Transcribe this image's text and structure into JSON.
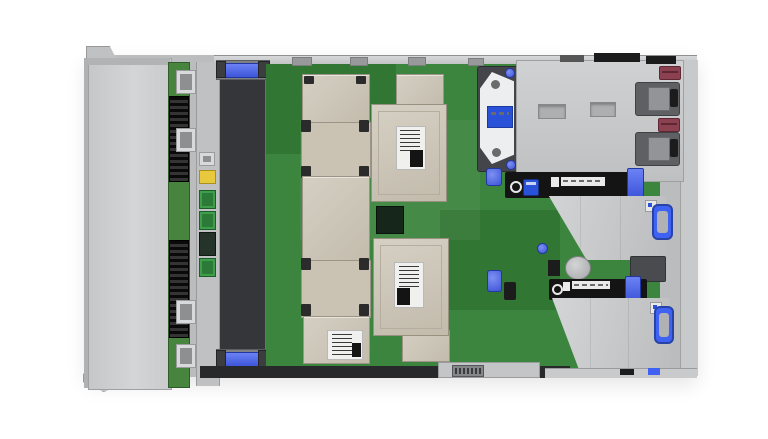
{
  "meta": {
    "title": "Rack server internal top view",
    "description": "Top-down photograph of a 2U rack server with its access panel removed, showing front drive cage, drive backplane, six hot-plug fan modules with magenta handles and blue release latches, two processor heatsinks on a green system board, CMOS coin battery, energy-pack bracket, two PCIe riser cages with blue touchpoint handles and labeled black bezels, and two power-supply handles with maroon pull tabs at the rear."
  },
  "palette": {
    "background": "#ffffff",
    "chassis_light": "#d4d5d7",
    "chassis_mid": "#bbbcbe",
    "chassis_dark": "#8f9092",
    "fan_body": "#46474a",
    "fan_handle_magenta": "#9c3752",
    "touchpoint_blue": "#3f62f2",
    "board_green": "#3c853e",
    "backplane_green": "#47853e",
    "heatsink_tan": "#ccc6ba",
    "copper_spring": "#c08448",
    "psu_tab_maroon": "#8c4150",
    "label_black": "#141414",
    "label_white": "#f0f0ee",
    "connector_green": "#3f9e4c",
    "battery_silver": "#b5b6b8"
  },
  "components": {
    "fan_bank": {
      "name": "hot-plug-fan-modules",
      "count": 6
    },
    "cpu_sockets": {
      "count": 2,
      "spring_screws_per_socket": 8
    },
    "heatsinks": {
      "count": 2
    },
    "riser_cages": {
      "count": 2
    },
    "power_supplies": {
      "handle_count": 2
    },
    "battery": {
      "name": "cmos-coin-battery",
      "count": 1
    },
    "energy_pack": {
      "name": "energy-pack-bracket",
      "count": 1
    },
    "drive_cage": {
      "name": "front-drive-cage-cover"
    }
  },
  "render": {
    "fans": {
      "count": 6,
      "x": 221,
      "y0": 78,
      "w": 44,
      "h": 45.5
    },
    "sockets": [
      {
        "x": 301,
        "y": 122
      },
      {
        "x": 301,
        "y": 260
      }
    ],
    "copper_dots": [
      [
        17,
        9
      ],
      [
        45,
        9
      ],
      [
        31,
        19
      ],
      [
        11,
        27
      ],
      [
        31,
        37
      ],
      [
        51,
        27
      ],
      [
        17,
        43
      ],
      [
        45,
        41
      ]
    ],
    "heatsinks": [
      {
        "x": 371,
        "y": 104
      },
      {
        "x": 373,
        "y": 238
      }
    ],
    "heatsink_screws": [
      [
        5,
        5
      ],
      [
        61,
        5
      ],
      [
        5,
        83
      ],
      [
        61,
        83
      ]
    ],
    "dimm_strips": [
      [
        320,
        102,
        42,
        10
      ],
      [
        320,
        176,
        42,
        10
      ],
      [
        320,
        246,
        42,
        10
      ],
      [
        336,
        320,
        26,
        10
      ]
    ],
    "chips": [
      [
        286,
        70,
        12,
        6,
        "a"
      ],
      [
        304,
        66,
        10,
        5,
        "b"
      ],
      [
        334,
        64,
        20,
        6,
        "d"
      ],
      [
        377,
        80,
        18,
        10,
        "b"
      ],
      [
        415,
        82,
        15,
        7,
        "b"
      ],
      [
        444,
        84,
        22,
        8,
        "b"
      ],
      [
        450,
        104,
        17,
        8,
        "b"
      ],
      [
        468,
        66,
        10,
        5,
        "a"
      ],
      [
        452,
        64,
        26,
        5,
        "d"
      ],
      [
        498,
        64,
        10,
        6,
        "b"
      ],
      [
        277,
        132,
        15,
        40,
        "b"
      ],
      [
        279,
        206,
        13,
        20,
        "b"
      ],
      [
        280,
        299,
        13,
        38,
        "b"
      ],
      [
        271,
        178,
        6,
        20,
        "d"
      ],
      [
        271,
        250,
        6,
        26,
        "d"
      ],
      [
        410,
        214,
        8,
        8,
        "a"
      ],
      [
        300,
        240,
        8,
        10,
        "a"
      ],
      [
        330,
        236,
        6,
        8,
        "b"
      ],
      [
        470,
        120,
        8,
        14,
        "b"
      ],
      [
        474,
        142,
        12,
        8,
        "a"
      ],
      [
        470,
        168,
        10,
        8,
        "b"
      ],
      [
        478,
        196,
        14,
        9,
        "b"
      ],
      [
        470,
        224,
        9,
        8,
        "a"
      ],
      [
        462,
        240,
        18,
        10,
        "b"
      ],
      [
        487,
        250,
        8,
        8,
        "c"
      ],
      [
        459,
        150,
        6,
        6,
        "c"
      ],
      [
        445,
        148,
        8,
        16,
        "b"
      ],
      [
        466,
        146,
        8,
        16,
        "b"
      ],
      [
        292,
        344,
        10,
        7,
        "b"
      ],
      [
        320,
        344,
        17,
        8,
        "b"
      ],
      [
        350,
        342,
        12,
        6,
        "a"
      ],
      [
        380,
        344,
        16,
        8,
        "b"
      ],
      [
        410,
        344,
        10,
        6,
        "a"
      ],
      [
        432,
        340,
        13,
        8,
        "b"
      ],
      [
        452,
        352,
        12,
        6,
        "b"
      ],
      [
        475,
        322,
        22,
        12,
        "b"
      ],
      [
        500,
        324,
        13,
        8,
        "a"
      ],
      [
        520,
        318,
        9,
        6,
        "b"
      ],
      [
        476,
        340,
        28,
        8,
        "a"
      ],
      [
        512,
        342,
        15,
        6,
        "b"
      ],
      [
        534,
        336,
        8,
        8,
        "a"
      ],
      [
        548,
        340,
        12,
        6,
        "b"
      ],
      [
        522,
        354,
        24,
        7,
        "a"
      ],
      [
        554,
        354,
        9,
        5,
        "b"
      ],
      [
        470,
        356,
        16,
        6,
        "b"
      ],
      [
        507,
        200,
        10,
        8,
        "c"
      ],
      [
        520,
        216,
        8,
        6,
        "a"
      ],
      [
        500,
        230,
        8,
        8,
        "a"
      ]
    ],
    "chip_colors": {
      "a": "#1b3a22",
      "b": "#121212",
      "c": "#c6c6c6",
      "d": "#2f6a33"
    },
    "rivets": [
      [
        98,
        155
      ],
      [
        124,
        155
      ],
      [
        150,
        155
      ],
      [
        98,
        168
      ],
      [
        124,
        168
      ],
      [
        150,
        168
      ],
      [
        98,
        253
      ],
      [
        124,
        253
      ],
      [
        150,
        253
      ],
      [
        98,
        266
      ],
      [
        124,
        266
      ],
      [
        150,
        266
      ]
    ],
    "rivet_dashes": [
      [
        111,
        160
      ],
      [
        137,
        160
      ],
      [
        111,
        258
      ],
      [
        137,
        258
      ]
    ],
    "cage_screws_dark": [
      [
        95,
        90
      ],
      [
        95,
        186
      ],
      [
        95,
        282
      ],
      [
        100,
        364
      ],
      [
        92,
        62
      ]
    ],
    "psu_dots": [
      [
        549,
        85
      ],
      [
        606,
        83
      ],
      [
        551,
        147
      ],
      [
        608,
        145
      ],
      [
        536,
        69
      ],
      [
        665,
        72
      ]
    ],
    "cage1_dots": [
      [
        590,
        213
      ],
      [
        606,
        227
      ],
      [
        648,
        205
      ],
      [
        650,
        245
      ],
      [
        572,
        203
      ]
    ],
    "cage2_dots": [
      [
        600,
        319
      ],
      [
        616,
        335
      ],
      [
        650,
        311
      ],
      [
        652,
        351
      ],
      [
        590,
        355
      ]
    ],
    "riser1_icons": {
      "x": 557,
      "y": 187,
      "n": 6,
      "w": 9,
      "h": 8,
      "step": 11
    },
    "riser2_icons": {
      "x": 557,
      "y": 290,
      "n": 6,
      "w": 8,
      "h": 7,
      "step": 10
    },
    "bottom_segments": [
      [
        212,
        368,
        24,
        4
      ],
      [
        252,
        369,
        18,
        4
      ],
      [
        300,
        368,
        28,
        4
      ],
      [
        354,
        369,
        20,
        4
      ],
      [
        398,
        368,
        16,
        4
      ],
      [
        470,
        369,
        14,
        4
      ],
      [
        520,
        368,
        16,
        4
      ]
    ],
    "fan_rail_dots_y": [
      100,
      148,
      196,
      244,
      292,
      336
    ]
  }
}
